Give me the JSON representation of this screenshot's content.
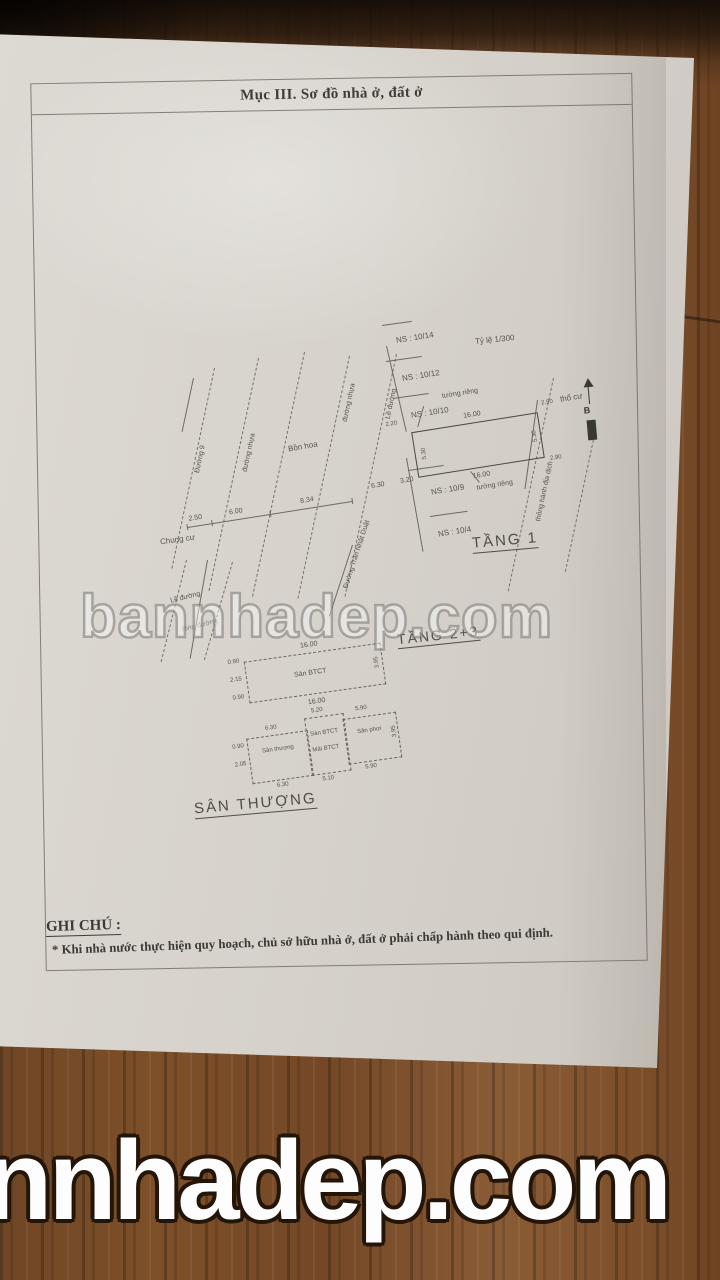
{
  "watermarks": {
    "middle": "bannhadep.com",
    "bottom": "nnhadep.com"
  },
  "header": {
    "section_title": "Mục III. Sơ đồ nhà ở, đất ở"
  },
  "plan": {
    "scale_label": "Tỷ lệ 1/300",
    "north_label": "B",
    "lots": [
      "NS : 10/14",
      "NS : 10/12",
      "NS : 10/10",
      "NS : 10/9",
      "NS : 10/4"
    ],
    "floor1": {
      "title": "TẦNG 1",
      "dim_top": "16.00",
      "dim_bottom": "16.00",
      "dim_left": "5.30",
      "dim_right": "5.30",
      "dim_out_top_right": "2.90",
      "dim_out_bottom_right": "2.90",
      "dim_out_left": "2.20",
      "dim_seg_a": "6.30",
      "dim_seg_b": "3.20",
      "wall_top": "tường riêng",
      "wall_bottom": "tường riêng",
      "residential_land": "thổ cư"
    },
    "roads": {
      "road_9": "Đường 9",
      "asphalt_1": "đường nhựa",
      "asphalt_2": "đường nhựa",
      "sidewalk_1": "Lề đường",
      "sidewalk_2": "Lề đường",
      "roadway": "lòng đường",
      "main_road": "Đường Trần Nhật Duật",
      "easement": "thông hành địa dịch"
    },
    "labels": {
      "flower_bed": "Bồn hoa",
      "apartment": "Chung cư"
    },
    "street_dims": [
      "2.50",
      "6.00",
      "8.34"
    ],
    "floor23": {
      "title": "TẦNG 2+3",
      "slab": "Sàn BTCT",
      "dim_top": "16.00",
      "dim_bottom": "16.00",
      "dim_right": "3.95",
      "left_dims": [
        "0.90",
        "2.15",
        "0.90"
      ]
    },
    "roof": {
      "title": "SÂN THƯỢNG",
      "left_name": "Sân thượng",
      "left_top": "6.30",
      "left_bottom": "6.30",
      "mid_name_1": "Sàn BTCT",
      "mid_name_2": "Mái BTCT",
      "mid_top": "5.20",
      "mid_bottom": "5.10",
      "right_name": "Sân phơi",
      "right_top": "5.90",
      "right_bottom": "5.90",
      "dim_right": "3.95",
      "left_dims": [
        "0.90",
        "2.05"
      ]
    },
    "note": {
      "title": "GHI CHÚ :",
      "text": "* Khi nhà nước thực hiện quy hoạch, chủ sở hữu nhà ở, đất ở phải chấp hành theo qui định."
    }
  }
}
